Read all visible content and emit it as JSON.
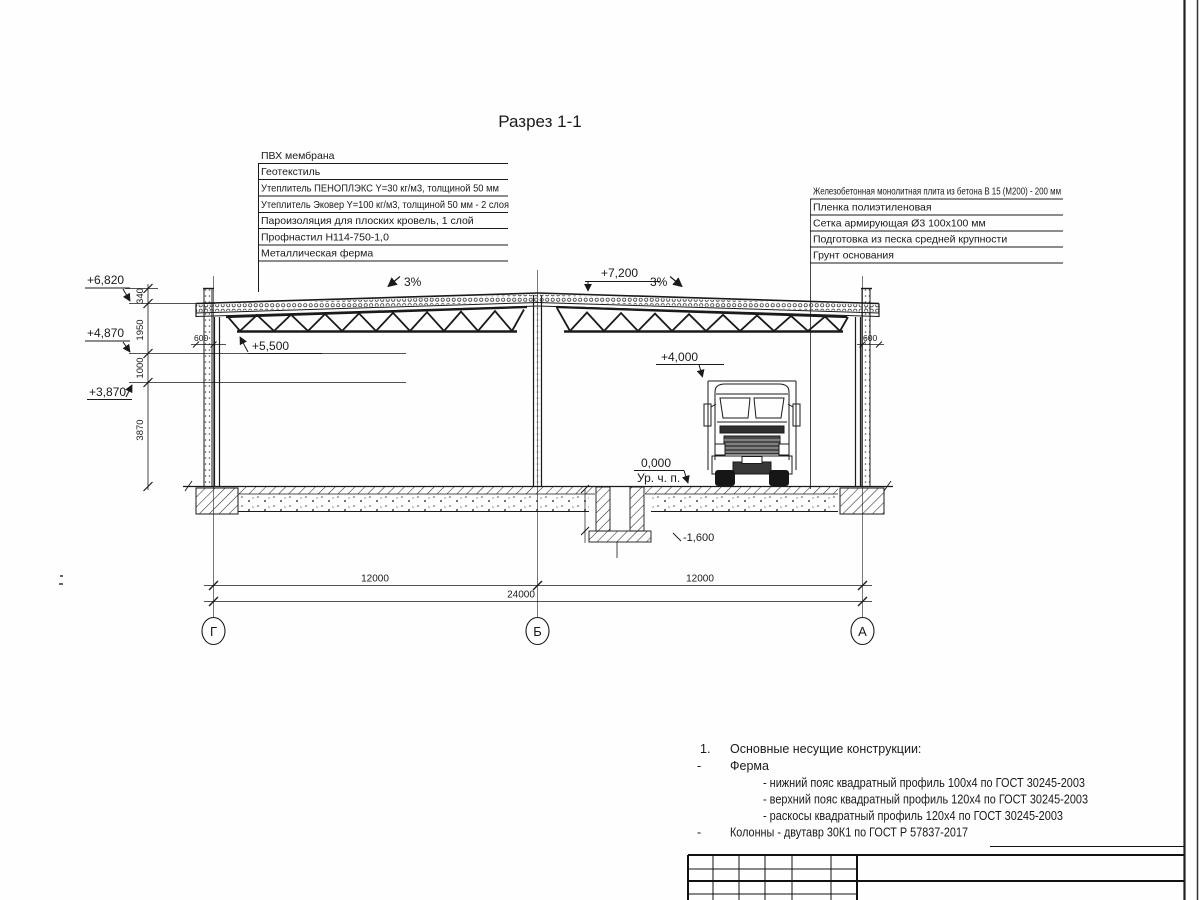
{
  "sheet": {
    "title": "Разрез 1-1"
  },
  "roof_layers": [
    "ПВХ мембрана",
    "Геотекстиль",
    "Утеплитель ПЕНОПЛЭКС Y=30 кг/м3, толщиной 50 мм",
    "Утеплитель Эковер Y=100 кг/м3, толщиной 50 мм - 2 слоя",
    "Пароизоляция для плоских кровель, 1 слой",
    "Профнастил Н114-750-1,0",
    "Металлическая ферма"
  ],
  "floor_layers": [
    "Железобетонная монолитная плита из бетона В 15 (М200) - 200 мм",
    "Пленка полиэтиленовая",
    "Сетка армирующая Ø3 100х100 мм",
    "Подготовка из песка средней крупности",
    "Грунт основания"
  ],
  "elevations": {
    "parapet": "+6,820",
    "eaves_level": "+4,870",
    "wall_level": "+3,870",
    "truss_bottom": "+5,500",
    "ridge": "+7,200",
    "truck_clearance": "+4,000",
    "floor": "0,000",
    "floor_note": "Ур. ч. п.",
    "pit_bottom": "-1,600"
  },
  "slopes": {
    "left": "3%",
    "right": "3%"
  },
  "dimensions": {
    "parapet_height": "340",
    "roof_zone": "1950",
    "band": "1000",
    "wall_height": "3870",
    "overhang_left": "600",
    "overhang_right": "600",
    "bay_left": "12000",
    "bay_right": "12000",
    "total_span": "24000"
  },
  "axes": {
    "left": "Г",
    "middle": "Б",
    "right": "А"
  },
  "notes": {
    "item1_no": "1.",
    "item1": "Основные несущие конструкции:",
    "dash1": "-",
    "truss_label": "Ферма",
    "truss_bottom_chord": "- нижний пояс квадратный профиль 100х4 по ГОСТ 30245-2003",
    "truss_top_chord": "- верхний пояс квадратный профиль 120х4 по ГОСТ 30245-2003",
    "truss_braces": "- раскосы квадратный профиль 120х4 по ГОСТ 30245-2003",
    "dash2": "-",
    "columns": "Колонны - двутавр 30К1 по ГОСТ Р 57837-2017"
  }
}
